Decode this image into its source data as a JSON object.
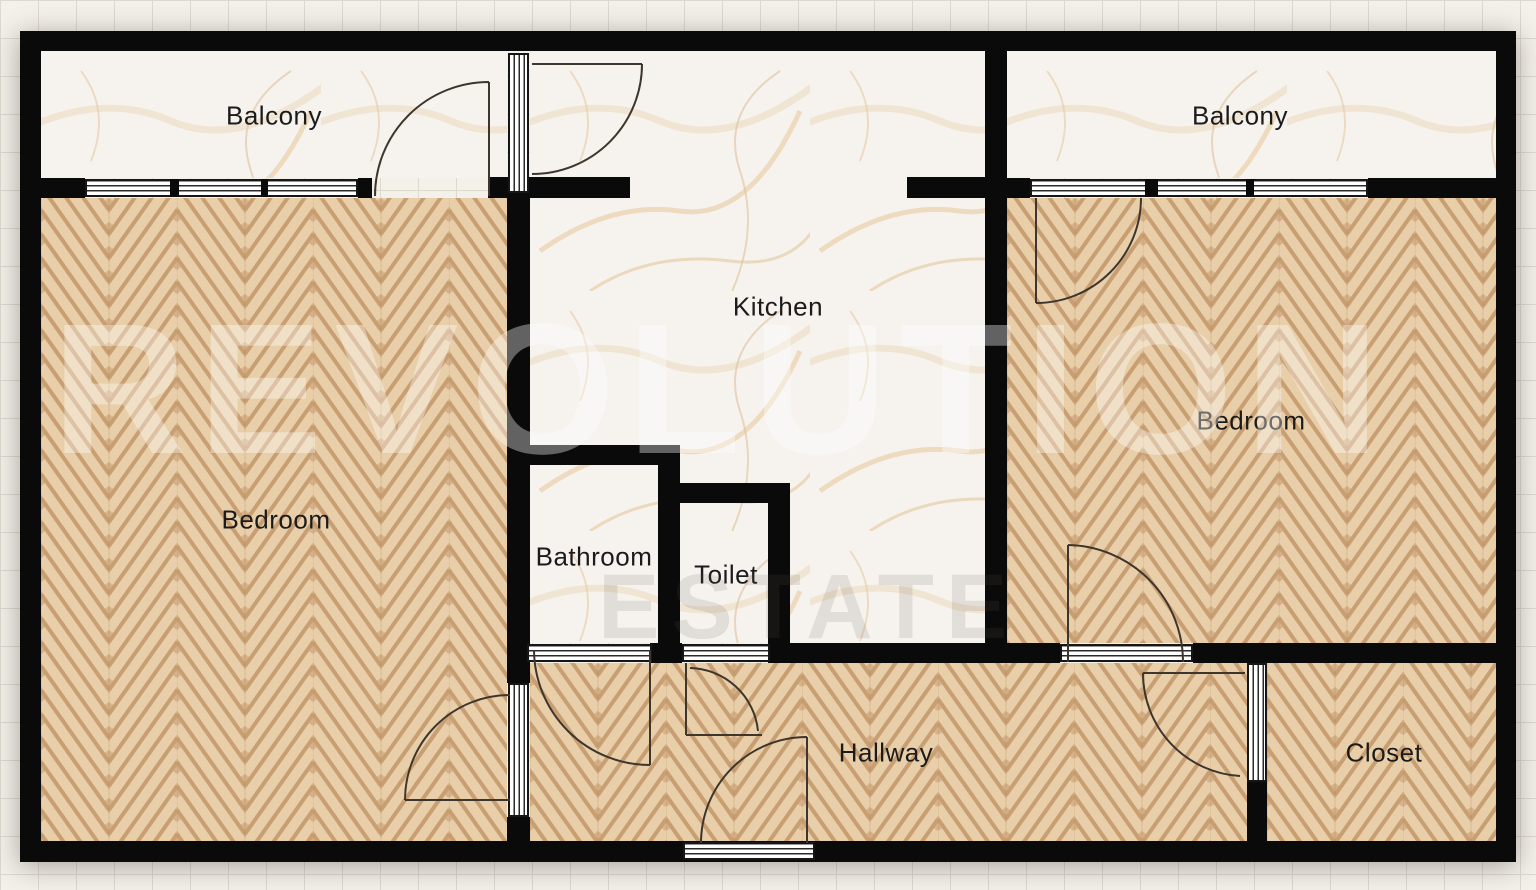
{
  "plan": {
    "watermark": {
      "line1": "REVOLUTION",
      "line2": "ESTATE"
    },
    "rooms": [
      {
        "id": "balcony-left",
        "label": "Balcony"
      },
      {
        "id": "kitchen",
        "label": "Kitchen"
      },
      {
        "id": "balcony-right",
        "label": "Balcony"
      },
      {
        "id": "bedroom-left",
        "label": "Bedroom"
      },
      {
        "id": "bedroom-right",
        "label": "Bedroom"
      },
      {
        "id": "bathroom",
        "label": "Bathroom"
      },
      {
        "id": "toilet",
        "label": "Toilet"
      },
      {
        "id": "hallway",
        "label": "Hallway"
      },
      {
        "id": "closet",
        "label": "Closet"
      }
    ],
    "colors": {
      "wall": "#0a0a0a",
      "wood_floor": "#d7b189",
      "marble_floor": "#f6f3ef",
      "paper_background": "#f4f1ea",
      "grid_line": "#ddd9cf",
      "door_arc": "#3e352c",
      "watermark_white": "rgba(255,255,255,0.36)"
    }
  }
}
